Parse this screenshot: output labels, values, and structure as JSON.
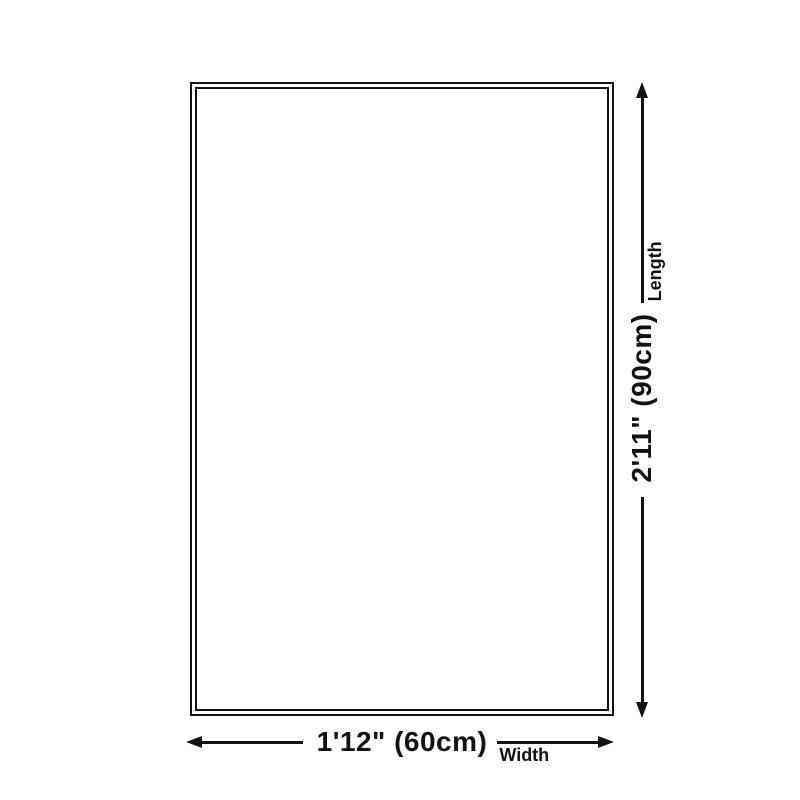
{
  "page": {
    "background": "#ffffff",
    "line_color": "#121212"
  },
  "diagram": {
    "shape": "rug-outline-rectangle",
    "width_dimension": {
      "value": "1'12\" (60cm)",
      "label": "Width"
    },
    "length_dimension": {
      "value": "2'11\" (90cm)",
      "label": "Length"
    }
  }
}
